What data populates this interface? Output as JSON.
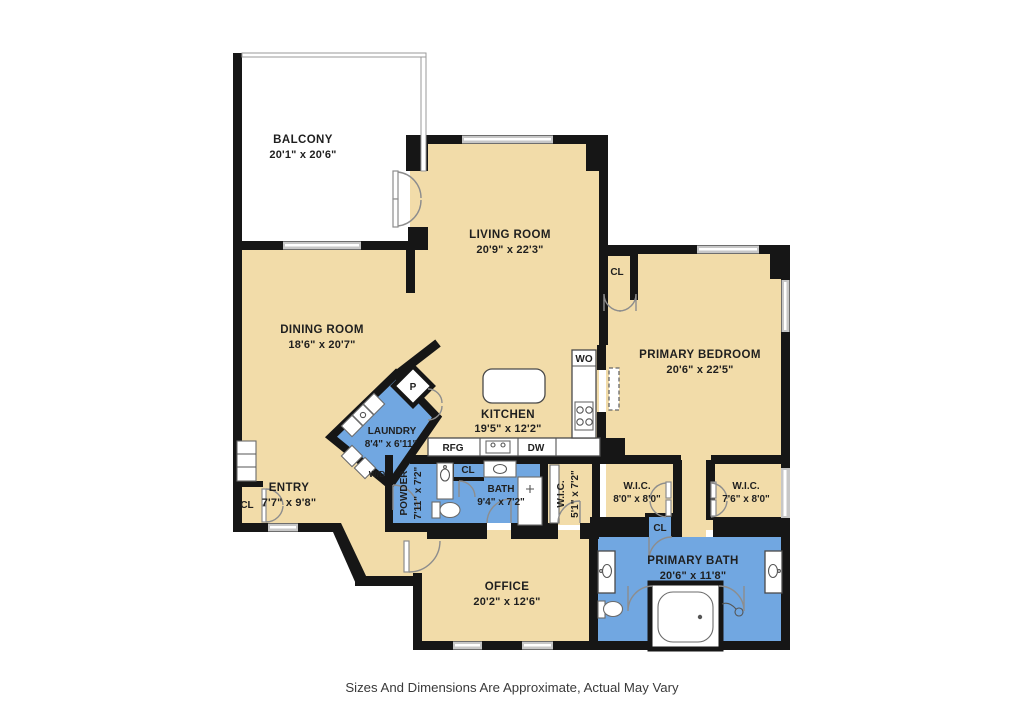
{
  "disclaimer": "Sizes And Dimensions Are Approximate, Actual May Vary",
  "colors": {
    "floor_tan": "#F2DCA9",
    "wet_blue": "#71A7E1",
    "wall_black": "#161616",
    "window_gray": "#C7C7C7"
  },
  "rooms": {
    "balcony": {
      "name": "BALCONY",
      "dims": "20'1\" x 20'6\""
    },
    "living_room": {
      "name": "LIVING ROOM",
      "dims": "20'9\" x 22'3\""
    },
    "dining_room": {
      "name": "DINING ROOM",
      "dims": "18'6\" x 20'7\""
    },
    "primary_bedroom": {
      "name": "PRIMARY BEDROOM",
      "dims": "20'6\" x 22'5\""
    },
    "kitchen": {
      "name": "KITCHEN",
      "dims": "19'5\" x 12'2\""
    },
    "laundry": {
      "name": "LAUNDRY",
      "dims": "8'4\" x 6'11\""
    },
    "entry": {
      "name": "ENTRY",
      "dims": "7'7\" x 9'8\""
    },
    "powder": {
      "name": "POWDER",
      "dims": "7'11\" x 7'2\""
    },
    "bath": {
      "name": "BATH",
      "dims": "9'4\" x 7'2\""
    },
    "wic_hall": {
      "name": "W.I.C.",
      "dims": "5'1\" x 7'2\""
    },
    "wic_left": {
      "name": "W.I.C.",
      "dims": "8'0\" x 8'0\""
    },
    "wic_right": {
      "name": "W.I.C.",
      "dims": "7'6\" x 8'0\""
    },
    "primary_bath": {
      "name": "PRIMARY BATH",
      "dims": "20'6\" x 11'8\""
    },
    "office": {
      "name": "OFFICE",
      "dims": "20'2\" x 12'6\""
    }
  },
  "labels": {
    "closet": "CL",
    "pantry": "P",
    "washer_dryer": "W/D",
    "refrigerator": "RFG",
    "dishwasher": "DW",
    "wall_oven": "WO"
  }
}
